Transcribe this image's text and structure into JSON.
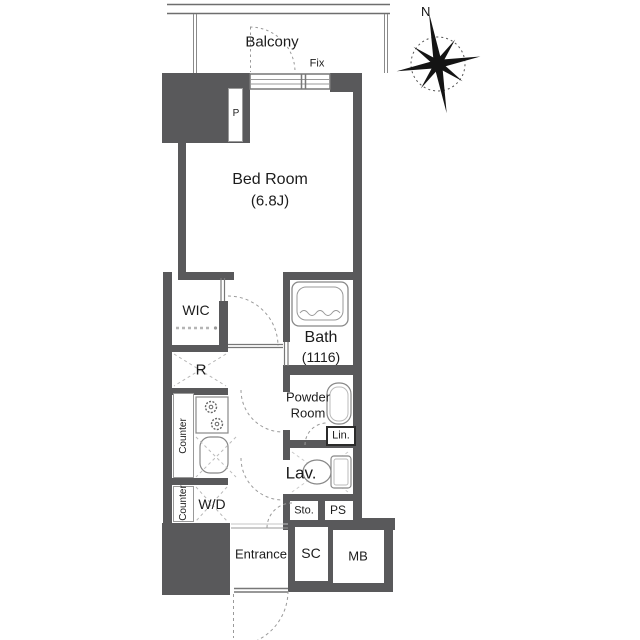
{
  "compass": {
    "north": "N"
  },
  "balcony": {
    "name": "Balcony",
    "fix_window_label": "Fix"
  },
  "rooms": {
    "bedroom": {
      "name": "Bed Room",
      "size": "(6.8J)"
    },
    "wic": {
      "name": "WIC"
    },
    "bath": {
      "name": "Bath",
      "size": "(1116)"
    },
    "powder_room": {
      "name_line1": "Powder",
      "name_line2": "Room"
    },
    "lavatory": {
      "name": "Lav."
    },
    "entrance": {
      "name": "Entrance"
    }
  },
  "fixtures": {
    "pipe_shaft": "P",
    "refrigerator_space": "R",
    "kitchen_counter_upper": "Counter",
    "kitchen_counter_lower": "Counter",
    "washer_dryer": "W/D",
    "linen_cabinet": "Lin.",
    "storage": "Sto.",
    "pipe_space": "PS",
    "shoe_closet": "SC",
    "meter_box": "MB"
  },
  "colors": {
    "wall": "#59595b",
    "fixture_line": "#888888",
    "dash_line": "#aaaaaa",
    "text": "#1c1c1c"
  }
}
